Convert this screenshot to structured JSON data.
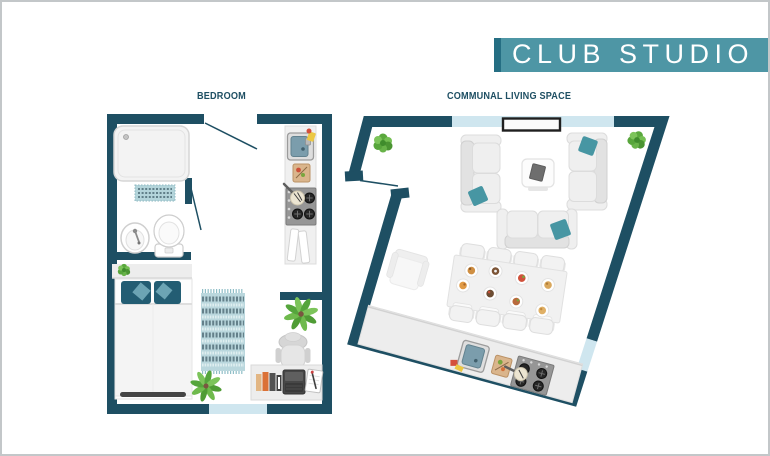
{
  "title_banner": {
    "text": "CLUB STUDIO"
  },
  "room_labels": {
    "bedroom": "BEDROOM",
    "communal": "COMMUNAL LIVING SPACE"
  },
  "colors": {
    "wall": "#1e4f63",
    "window": "#cfe6ef",
    "banner-bg": "#4e96a5",
    "banner-accent": "#256e83",
    "banner-text": "#ffffff",
    "label": "#1e4f63",
    "pillow-dark": "#235d73",
    "pillow-accent": "#6ca4b4",
    "pillow-teal": "#4796a3",
    "plant-green": "#5aa83d",
    "rug-base": "#bad7dd"
  },
  "rooms": {
    "bedroom": {
      "label": "BEDROOM",
      "furniture": [
        "shower",
        "bath-mat",
        "washbasin",
        "toilet",
        "partition-walls",
        "headboard-shelf",
        "pillows",
        "double-bed",
        "rug",
        "floor-plant",
        "kitchenette-sink",
        "cutting-board",
        "stove-hob",
        "open-cabinet",
        "desk",
        "desk-chair",
        "books",
        "laptop",
        "notepad",
        "desk-plant"
      ]
    },
    "communal_living_space": {
      "label": "COMMUNAL LIVING SPACE",
      "furniture": [
        "sofa-left",
        "sofa-right",
        "sofa-bottom",
        "coffee-table",
        "wall-tv",
        "armchair",
        "dining-table",
        "dining-chairs-x8",
        "food-plates-x8",
        "kitchen-counter",
        "kitchen-sink",
        "cutting-board",
        "stove-hob",
        "plants-x2"
      ]
    }
  }
}
